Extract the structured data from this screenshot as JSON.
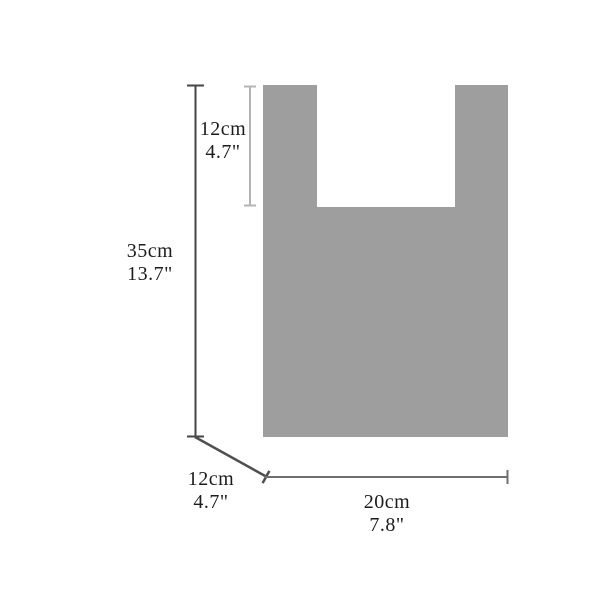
{
  "diagram": {
    "subject": "bag-dimension-diagram",
    "background_color": "#ffffff",
    "bag": {
      "shape": "t-shirt-bag-front-silhouette",
      "fill_color": "#9e9e9f"
    },
    "line_colors": {
      "height_line": "#454545",
      "handle_line": "#b4b4b4",
      "depth_line": "#4f4f4f",
      "width_line": "#6f6f6f"
    },
    "text_color": "#1c1c1c",
    "dimensions": {
      "handle_height": {
        "cm": "12cm",
        "inch": "4.7\""
      },
      "total_height": {
        "cm": "35cm",
        "inch": "13.7\""
      },
      "depth": {
        "cm": "12cm",
        "inch": "4.7\""
      },
      "width": {
        "cm": "20cm",
        "inch": "7.8\""
      }
    }
  }
}
